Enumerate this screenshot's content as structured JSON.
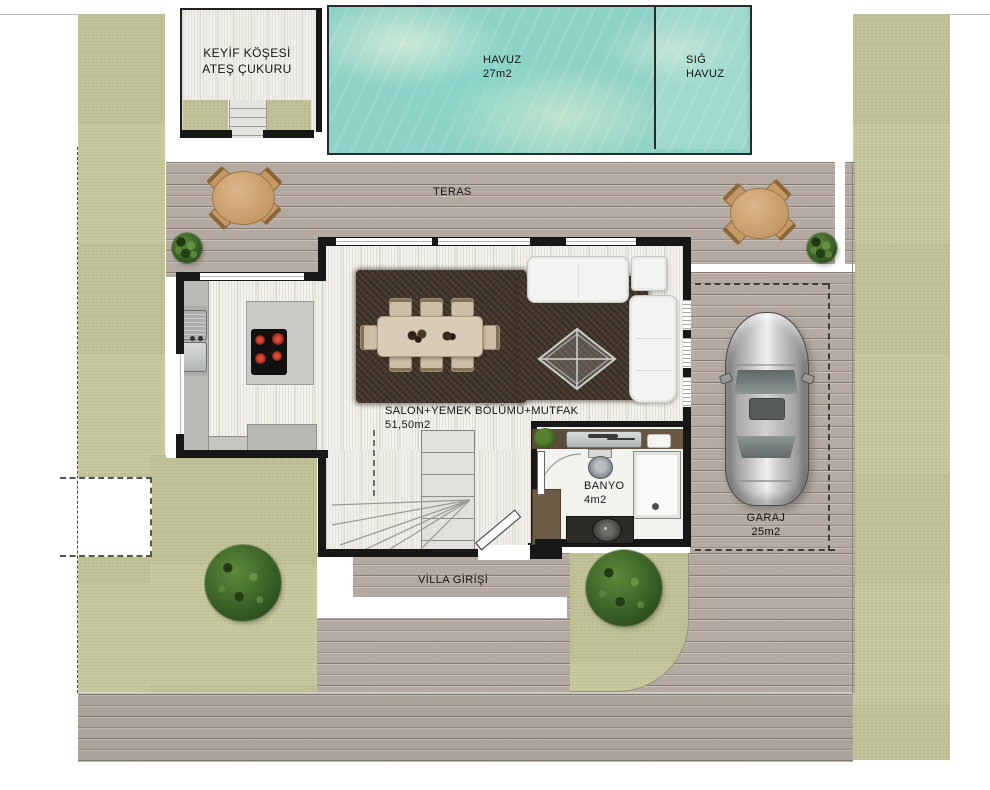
{
  "palette": {
    "grass": "#c6c79b",
    "brick": "#b4aaa1",
    "water": "#8ed2c7",
    "wall": "#171717",
    "rug": "#46392e",
    "floor": "#f3f2ec",
    "label": "#141414"
  },
  "labels": {
    "keyif": {
      "line1": "KEYİF KÖŞESİ",
      "line2": "ATEŞ ÇUKURU"
    },
    "havuz": {
      "name": "HAVUZ",
      "area": "27m2"
    },
    "sig_havuz": {
      "line1": "SIĞ",
      "line2": "HAVUZ"
    },
    "teras": {
      "name": "TERAS"
    },
    "salon": {
      "name": "SALON+YEMEK BÖLÜMÜ+MUTFAK",
      "area": "51,50m2"
    },
    "banyo": {
      "name": "BANYO",
      "area": "4m2"
    },
    "garaj": {
      "name": "GARAJ",
      "area": "25m2"
    },
    "giris": {
      "name": "VİLLA GİRİŞİ"
    }
  }
}
